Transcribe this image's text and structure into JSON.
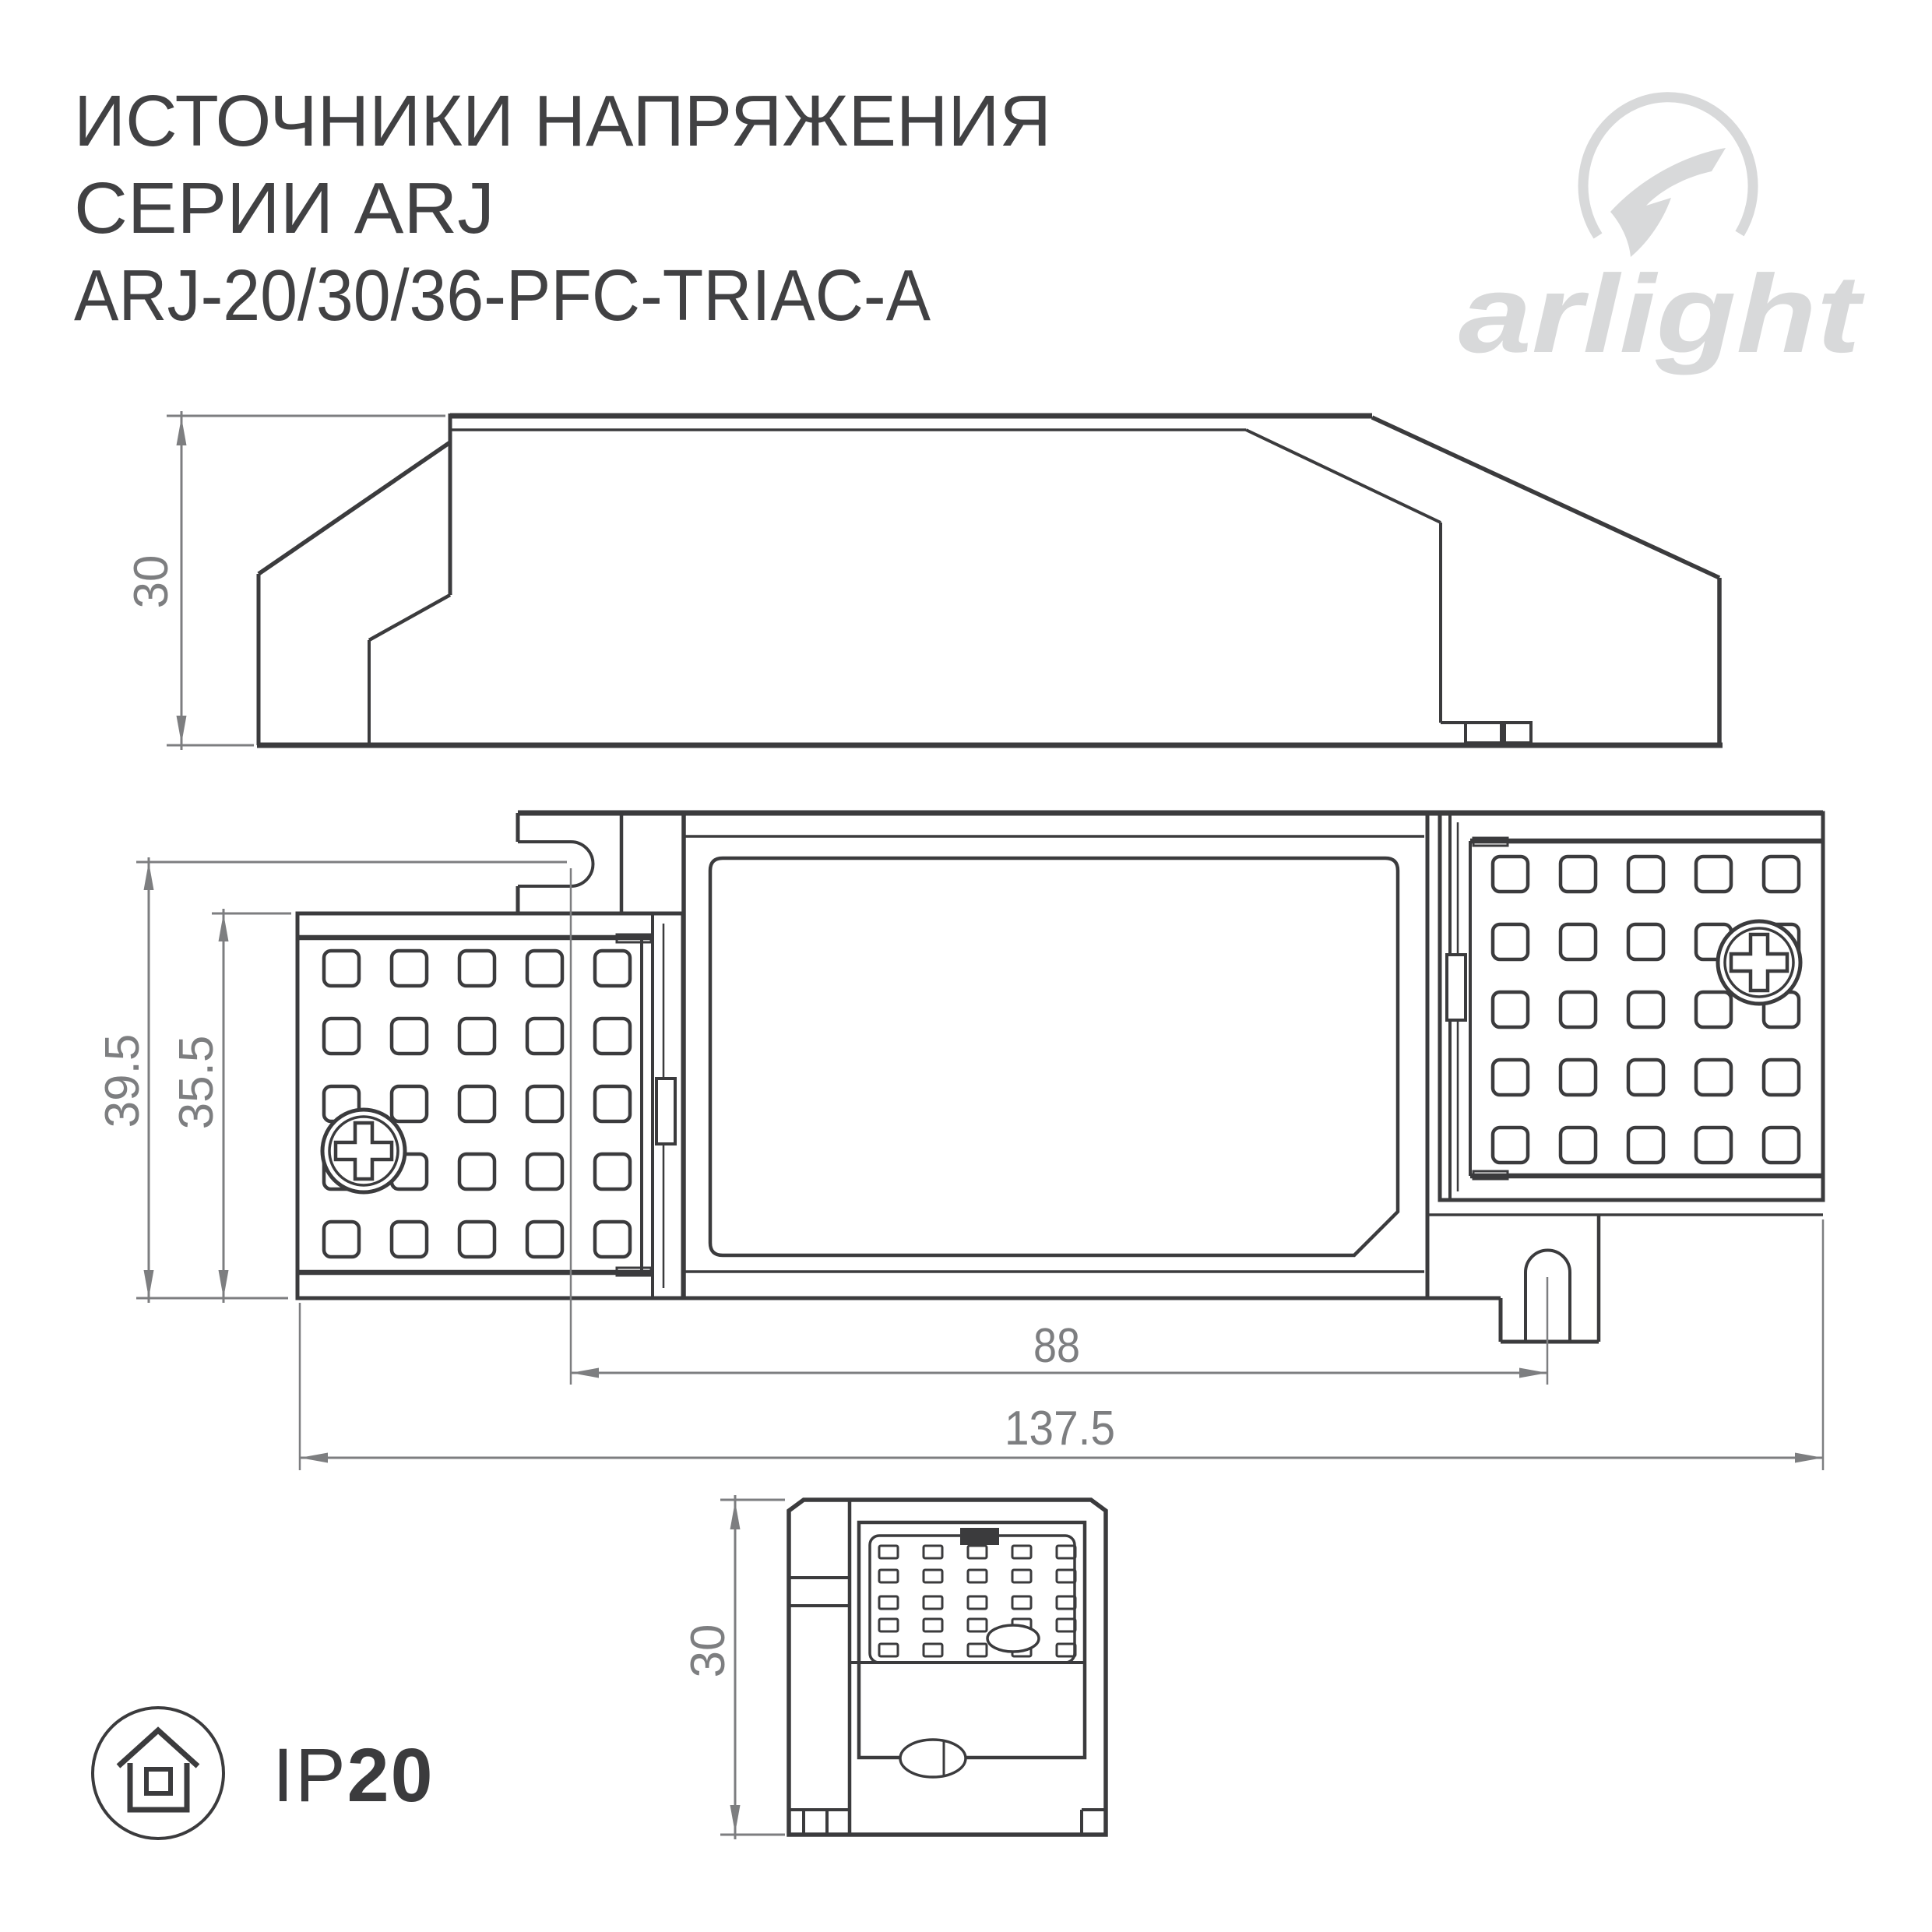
{
  "title": {
    "line1": "ИСТОЧНИКИ НАПРЯЖЕНИЯ",
    "line2": "СЕРИИ ARJ",
    "line3": "ARJ-20/30/36-PFC-TRIAC-A"
  },
  "logo": {
    "wordmark": "arlight"
  },
  "views": {
    "side": {
      "height_dim": "30"
    },
    "plan": {
      "outer_height_dim": "39.5",
      "inner_height_dim": "35.5",
      "slot_distance_dim": "88",
      "overall_length_dim": "137.5"
    },
    "end": {
      "height_dim": "30"
    }
  },
  "badge": {
    "prefix": "IP",
    "rating": "20"
  },
  "colors": {
    "line": "#3b3b3d",
    "dimension": "#7d7e80",
    "logo": "#d8d9da",
    "title": "#414143",
    "background": "#ffffff"
  }
}
